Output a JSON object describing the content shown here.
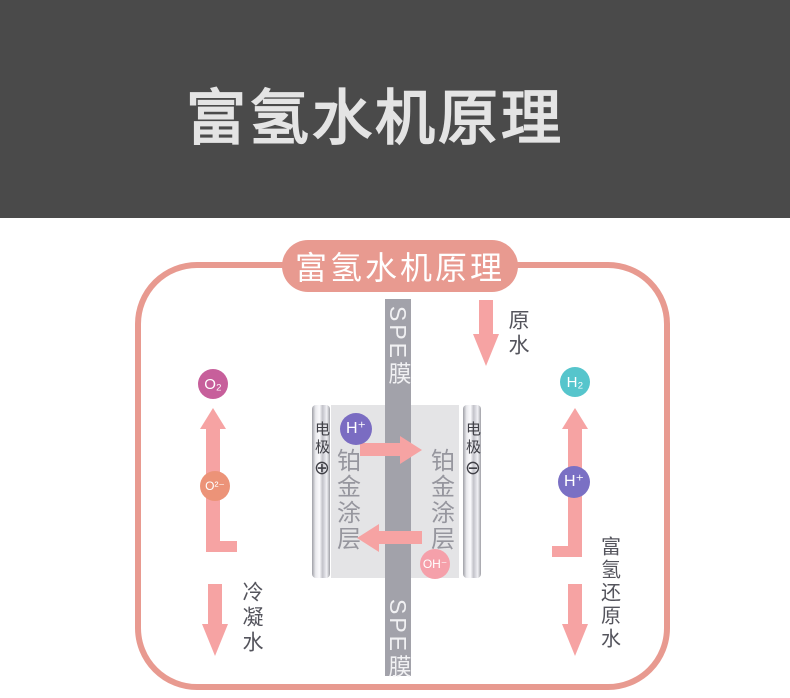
{
  "header": {
    "title": "富氢水机原理",
    "bg_color": "#4a4a4a",
    "text_color": "#e4e4e4"
  },
  "diagram": {
    "title": "富氢水机原理",
    "frame_color": "#e89a90",
    "arrow_color": "#f6a3a3",
    "spe_membrane_top": "SPE膜",
    "spe_membrane_bottom": "SPE膜",
    "raw_water_label": "原水",
    "condensed_water_label": "冷凝水",
    "hydrogen_rich_water_label": "富氢还原水",
    "cell": {
      "electrode_left_label": "电极",
      "electrode_left_polarity": "⊕",
      "electrode_right_label": "电极",
      "electrode_right_polarity": "⊖",
      "coating_left": "铂金涂层",
      "coating_right": "铂金涂层"
    },
    "particles": {
      "o2": {
        "label": "O₂",
        "color": "#c75f9b"
      },
      "o_ion": {
        "label": "O²⁻",
        "color": "#ec9378"
      },
      "h_ion_left": {
        "label": "H⁺",
        "color": "#7a6cc2"
      },
      "h2": {
        "label": "H₂",
        "color": "#56c5cc"
      },
      "h_ion_right": {
        "label": "H⁺",
        "color": "#7a70c4"
      },
      "oh_ion": {
        "label": "OH⁻",
        "color": "#f5a0aa"
      }
    }
  }
}
